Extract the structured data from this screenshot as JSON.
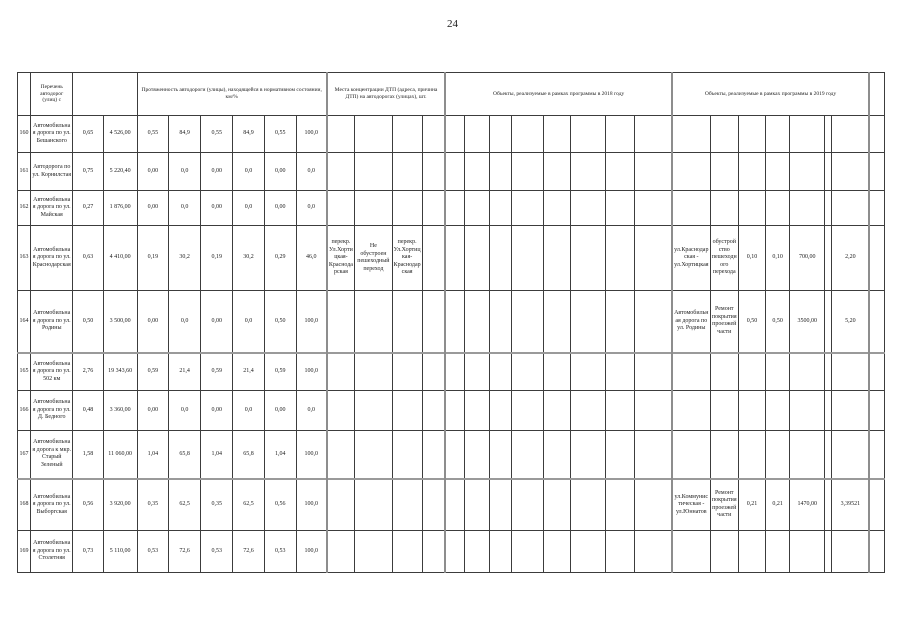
{
  "page": {
    "number": "24"
  },
  "table": {
    "headers": {
      "col_name": "Перечень автодорог (улиц) с",
      "col_length": "Протяженность автодороги (улицы), находящейся в нормативном состоянии, км/%",
      "col_dtp": "Места концентрации ДТП (адреса, причина ДТП) на автодорогах (улицах), шт.",
      "col_2018": "Объекты, реализуемые в рамках программы в 2018 году",
      "col_2019": "Объекты, реализуемые в рамках программы в 2019 году"
    },
    "rows": [
      {
        "num": "160",
        "name": "Автомобильная дорога по ул. Бешанского",
        "len": "0,65",
        "area": "4 526,00",
        "p": [
          "0,55",
          "84,9",
          "0,55",
          "84,9",
          "0,55",
          "100,0"
        ]
      },
      {
        "num": "161",
        "name": "Автодорога по ул. Корнилстая",
        "len": "0,75",
        "area": "5 220,40",
        "p": [
          "0,00",
          "0,0",
          "0,00",
          "0,0",
          "0,00",
          "0,0"
        ]
      },
      {
        "num": "162",
        "name": "Автомобильная дорога по ул. Майская",
        "len": "0,27",
        "area": "1 876,00",
        "p": [
          "0,00",
          "0,0",
          "0,00",
          "0,0",
          "0,00",
          "0,0"
        ]
      },
      {
        "num": "163",
        "name": "Автомобильная дорога по ул. Краснодарская",
        "len": "0,63",
        "area": "4 410,00",
        "p": [
          "0,19",
          "30,2",
          "0,19",
          "30,2",
          "0,29",
          "46,0"
        ],
        "dtp": [
          "перекр. Ул.Хортицкая-Краснодарская",
          "Не обустроен пешеходный переход",
          "перекр. Ул.Хортицкая-Краснодарская",
          ""
        ],
        "y2019": [
          "ул.Краснодарская - ул.Хортицкая",
          "обустройство пешеходного перехода",
          "0,10",
          "0,10",
          "700,00",
          "",
          "2,20"
        ]
      },
      {
        "num": "164",
        "name": "Автомобильная дорога по ул. Родины",
        "len": "0,50",
        "area": "3 500,00",
        "p": [
          "0,00",
          "0,0",
          "0,00",
          "0,0",
          "0,50",
          "100,0"
        ],
        "y2019": [
          "Автомобильная дорога по ул. Родины",
          "Ремонт покрытия проезжей части",
          "0,50",
          "0,50",
          "3500,00",
          "",
          "5,20"
        ]
      },
      {
        "num": "165",
        "name": "Автомобильная дорога по ул. 502 км",
        "len": "2,76",
        "area": "19 343,60",
        "p": [
          "0,59",
          "21,4",
          "0,59",
          "21,4",
          "0,59",
          "100,0"
        ]
      },
      {
        "num": "166",
        "name": "Автомобильная дорога по ул. Д. Бедного",
        "len": "0,48",
        "area": "3 360,00",
        "p": [
          "0,00",
          "0,0",
          "0,00",
          "0,0",
          "0,00",
          "0,0"
        ]
      },
      {
        "num": "167",
        "name": "Автомобильная дорога к мкр. Старый Зеленый",
        "len": "1,58",
        "area": "11 060,00",
        "p": [
          "1,04",
          "65,8",
          "1,04",
          "65,8",
          "1,04",
          "100,0"
        ]
      },
      {
        "num": "168",
        "name": "Автомобильная дорога по ул. Выборгская",
        "len": "0,56",
        "area": "3 920,00",
        "p": [
          "0,35",
          "62,5",
          "0,35",
          "62,5",
          "0,56",
          "100,0"
        ],
        "y2019": [
          "ул.Коммунистическая - ул.Юннатов",
          "Ремонт покрытия проезжей части",
          "0,21",
          "0,21",
          "1470,00",
          "",
          "3,39521"
        ]
      },
      {
        "num": "169",
        "name": "Автомобильная дорога по ул. Столетняя",
        "len": "0,73",
        "area": "5 110,00",
        "p": [
          "0,53",
          "72,6",
          "0,53",
          "72,6",
          "0,53",
          "100,0"
        ]
      }
    ]
  }
}
